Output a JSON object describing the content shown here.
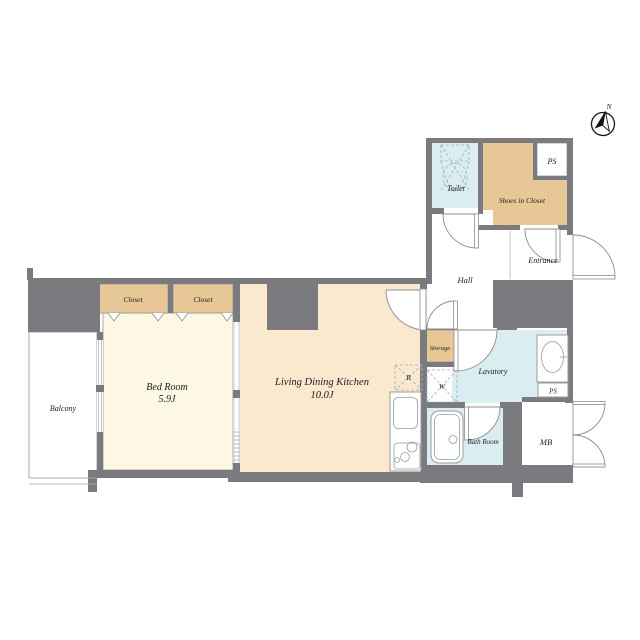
{
  "palette": {
    "wall": "#7b7b7f",
    "bedroom": "#fcf8e3",
    "tan": "#e6c795",
    "ldk": "#fae8cf",
    "wet": "#daeef2",
    "outline": "#96968e",
    "fixture": "#9b9b9b",
    "dash": "#9fb0bd",
    "text": "#1c1c1c"
  },
  "compass": {
    "north_label": "N"
  },
  "rooms": {
    "balcony": {
      "label": "Balcony"
    },
    "bedroom": {
      "label": "Bed Room",
      "area": "5.9J"
    },
    "closet_left": {
      "label": "Closet"
    },
    "closet_right": {
      "label": "Closet"
    },
    "ldk": {
      "label": "Living Dining Kitchen",
      "area": "10.0J"
    },
    "toilet": {
      "label": "Toilet"
    },
    "shoes_in_closet": {
      "label": "Shoes in Closet"
    },
    "ps_upper": {
      "label": "PS"
    },
    "hall": {
      "label": "Hall"
    },
    "entrance": {
      "label": "Entrance"
    },
    "storage": {
      "label": "Storage"
    },
    "lavatory": {
      "label": "Lavatory"
    },
    "ps_lower": {
      "label": "PS"
    },
    "bath_room": {
      "label": "Bath Room"
    },
    "meter_box": {
      "label": "MB"
    },
    "refrigerator": {
      "label": "R"
    },
    "washer": {
      "label": "W"
    }
  }
}
